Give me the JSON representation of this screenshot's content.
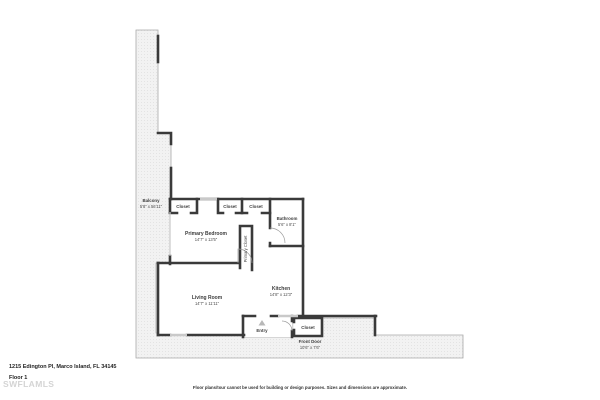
{
  "footer": {
    "address": "1215 Edington Pl, Marco Island, FL 34145",
    "floor_label": "Floor 1",
    "watermark": "SWFLAMLS",
    "disclaimer": "Floor plans/tour cannot be used for building or design purposes. Sizes and dimensions are approximate."
  },
  "rooms": {
    "balcony": {
      "name": "Balcony",
      "dims": "5'8\" x 56'11\""
    },
    "closet_1": {
      "name": "Closet"
    },
    "closet_2": {
      "name": "Closet"
    },
    "closet_3": {
      "name": "Closet"
    },
    "primary_bedroom": {
      "name": "Primary Bedroom",
      "dims": "14'7\" x 13'5\""
    },
    "primary_closet": {
      "name": "Primary Closet"
    },
    "bathroom": {
      "name": "Bathroom",
      "dims": "5'6\" x 8'1\""
    },
    "kitchen": {
      "name": "Kitchen",
      "dims": "14'8\" x 12'3\""
    },
    "living_room": {
      "name": "Living Room",
      "dims": "14'7\" x 11'11\""
    },
    "entry": {
      "name": "Entry"
    },
    "entry_closet": {
      "name": "Closet"
    },
    "front_door": {
      "name": "Front Door",
      "dims": "10'6\" x 7'6\""
    }
  },
  "colors": {
    "wall": "#3a3a3a",
    "outdoor_fill": "#f2f2f2",
    "window": "#c9c9c9",
    "label_text": "#3d3d3d",
    "watermark": "#d4d4d4"
  }
}
